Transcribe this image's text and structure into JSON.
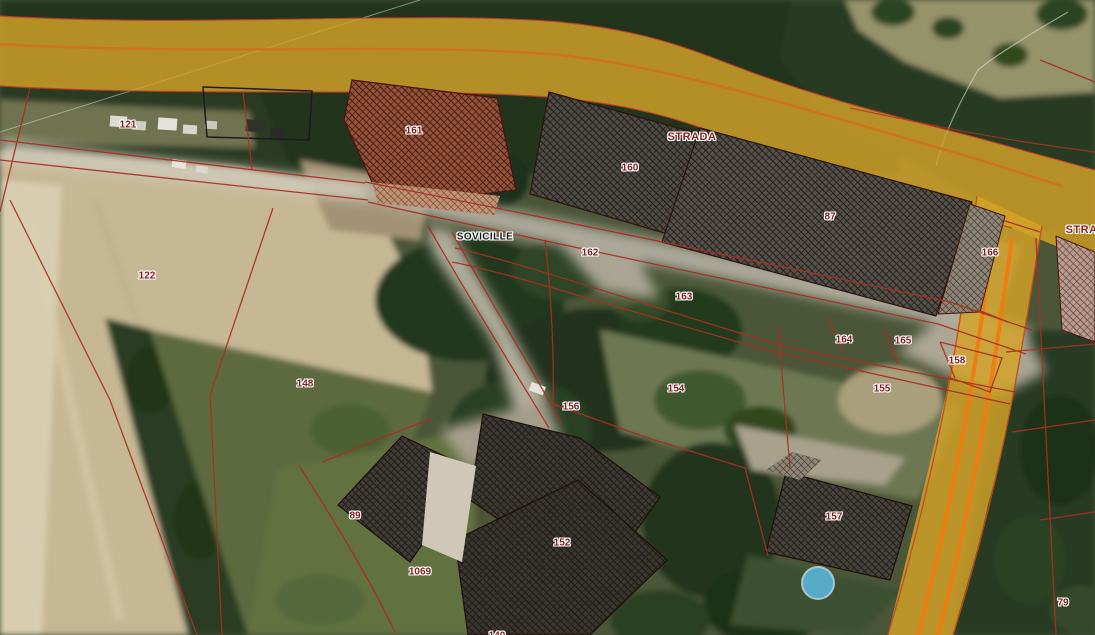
{
  "map": {
    "description_labels_note": "cadastral overlay on aerial imagery",
    "labels": [
      {
        "text": "121",
        "x": 128,
        "y": 125,
        "kind": "parcel"
      },
      {
        "text": "161",
        "x": 414,
        "y": 131,
        "kind": "parcel"
      },
      {
        "text": "STRADA",
        "x": 692,
        "y": 137,
        "kind": "road"
      },
      {
        "text": "160",
        "x": 630,
        "y": 168,
        "kind": "parcel"
      },
      {
        "text": "87",
        "x": 830,
        "y": 217,
        "kind": "parcel"
      },
      {
        "text": "STRADA",
        "x": 1090,
        "y": 230,
        "kind": "road"
      },
      {
        "text": "SOVICILLE",
        "x": 485,
        "y": 237,
        "kind": "place"
      },
      {
        "text": "162",
        "x": 590,
        "y": 253,
        "kind": "parcel"
      },
      {
        "text": "166",
        "x": 990,
        "y": 253,
        "kind": "parcel"
      },
      {
        "text": "122",
        "x": 147,
        "y": 276,
        "kind": "parcel"
      },
      {
        "text": "163",
        "x": 684,
        "y": 297,
        "kind": "parcel"
      },
      {
        "text": "164",
        "x": 844,
        "y": 340,
        "kind": "parcel"
      },
      {
        "text": "165",
        "x": 903,
        "y": 341,
        "kind": "parcel"
      },
      {
        "text": "158",
        "x": 957,
        "y": 361,
        "kind": "parcel"
      },
      {
        "text": "148",
        "x": 305,
        "y": 384,
        "kind": "parcel"
      },
      {
        "text": "154",
        "x": 676,
        "y": 389,
        "kind": "parcel"
      },
      {
        "text": "155",
        "x": 882,
        "y": 389,
        "kind": "parcel"
      },
      {
        "text": "156",
        "x": 571,
        "y": 407,
        "kind": "parcel"
      },
      {
        "text": "89",
        "x": 355,
        "y": 516,
        "kind": "parcel"
      },
      {
        "text": "157",
        "x": 834,
        "y": 517,
        "kind": "parcel"
      },
      {
        "text": "152",
        "x": 562,
        "y": 543,
        "kind": "parcel"
      },
      {
        "text": "1069",
        "x": 420,
        "y": 572,
        "kind": "parcel"
      },
      {
        "text": "79",
        "x": 1063,
        "y": 603,
        "kind": "parcel"
      },
      {
        "text": "140",
        "x": 497,
        "y": 636,
        "kind": "parcel"
      }
    ],
    "colors": {
      "road_overlay_yellow": "#d4a427",
      "road_centerline_orange": "#ee7d12",
      "cadastral_line_red": "#a82f22",
      "parcel_label_text": "#7e1d1d",
      "road_label_text": "#8a1f1f",
      "place_label_text": "#161616"
    }
  }
}
